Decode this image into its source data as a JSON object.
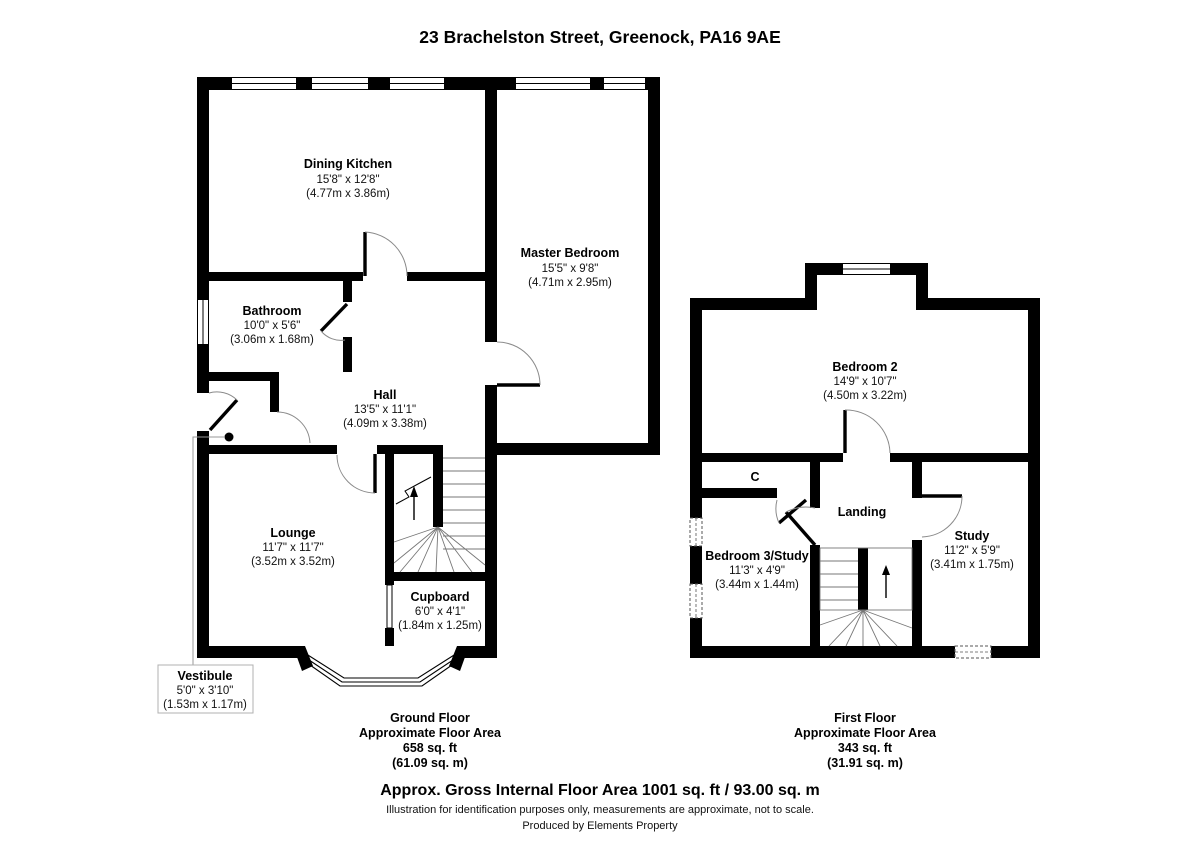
{
  "title": "23 Brachelston Street, Greenock, PA16 9AE",
  "colors": {
    "wall_color": "#000000",
    "background": "#ffffff",
    "door_arc_color": "#8a8a8a",
    "label_box_border": "#b0b0b0"
  },
  "ground_floor": {
    "rooms": {
      "dining_kitchen": {
        "name": "Dining Kitchen",
        "imperial": "15'8\" x 12'8\"",
        "metric": "(4.77m x 3.86m)"
      },
      "master_bedroom": {
        "name": "Master Bedroom",
        "imperial": "15'5\" x 9'8\"",
        "metric": "(4.71m x 2.95m)"
      },
      "bathroom": {
        "name": "Bathroom",
        "imperial": "10'0\" x 5'6\"",
        "metric": "(3.06m x 1.68m)"
      },
      "hall": {
        "name": "Hall",
        "imperial": "13'5\" x 11'1\"",
        "metric": "(4.09m x 3.38m)"
      },
      "lounge": {
        "name": "Lounge",
        "imperial": "11'7\" x 11'7\"",
        "metric": "(3.52m x 3.52m)"
      },
      "cupboard": {
        "name": "Cupboard",
        "imperial": "6'0\" x 4'1\"",
        "metric": "(1.84m x 1.25m)"
      },
      "vestibule": {
        "name": "Vestibule",
        "imperial": "5'0\" x 3'10\"",
        "metric": "(1.53m x 1.17m)"
      }
    },
    "summary": {
      "line1": "Ground Floor",
      "line2": "Approximate Floor Area",
      "line3": "658 sq. ft",
      "line4": "(61.09 sq. m)"
    }
  },
  "first_floor": {
    "rooms": {
      "bedroom_2": {
        "name": "Bedroom 2",
        "imperial": "14'9\" x 10'7\"",
        "metric": "(4.50m x 3.22m)"
      },
      "bedroom_3_study": {
        "name": "Bedroom 3/Study",
        "imperial": "11'3\" x 4'9\"",
        "metric": "(3.44m x 1.44m)"
      },
      "study": {
        "name": "Study",
        "imperial": "11'2\" x 5'9\"",
        "metric": "(3.41m x 1.75m)"
      },
      "landing": {
        "name": "Landing"
      },
      "cupboard_c": {
        "name": "C"
      }
    },
    "summary": {
      "line1": "First Floor",
      "line2": "Approximate Floor Area",
      "line3": "343 sq. ft",
      "line4": "(31.91 sq. m)"
    }
  },
  "footer": {
    "gross_area": "Approx. Gross Internal Floor Area 1001 sq. ft / 93.00 sq. m",
    "disclaimer": "Illustration for identification purposes only, measurements are approximate, not to scale.",
    "produced_by": "Produced by Elements Property"
  }
}
